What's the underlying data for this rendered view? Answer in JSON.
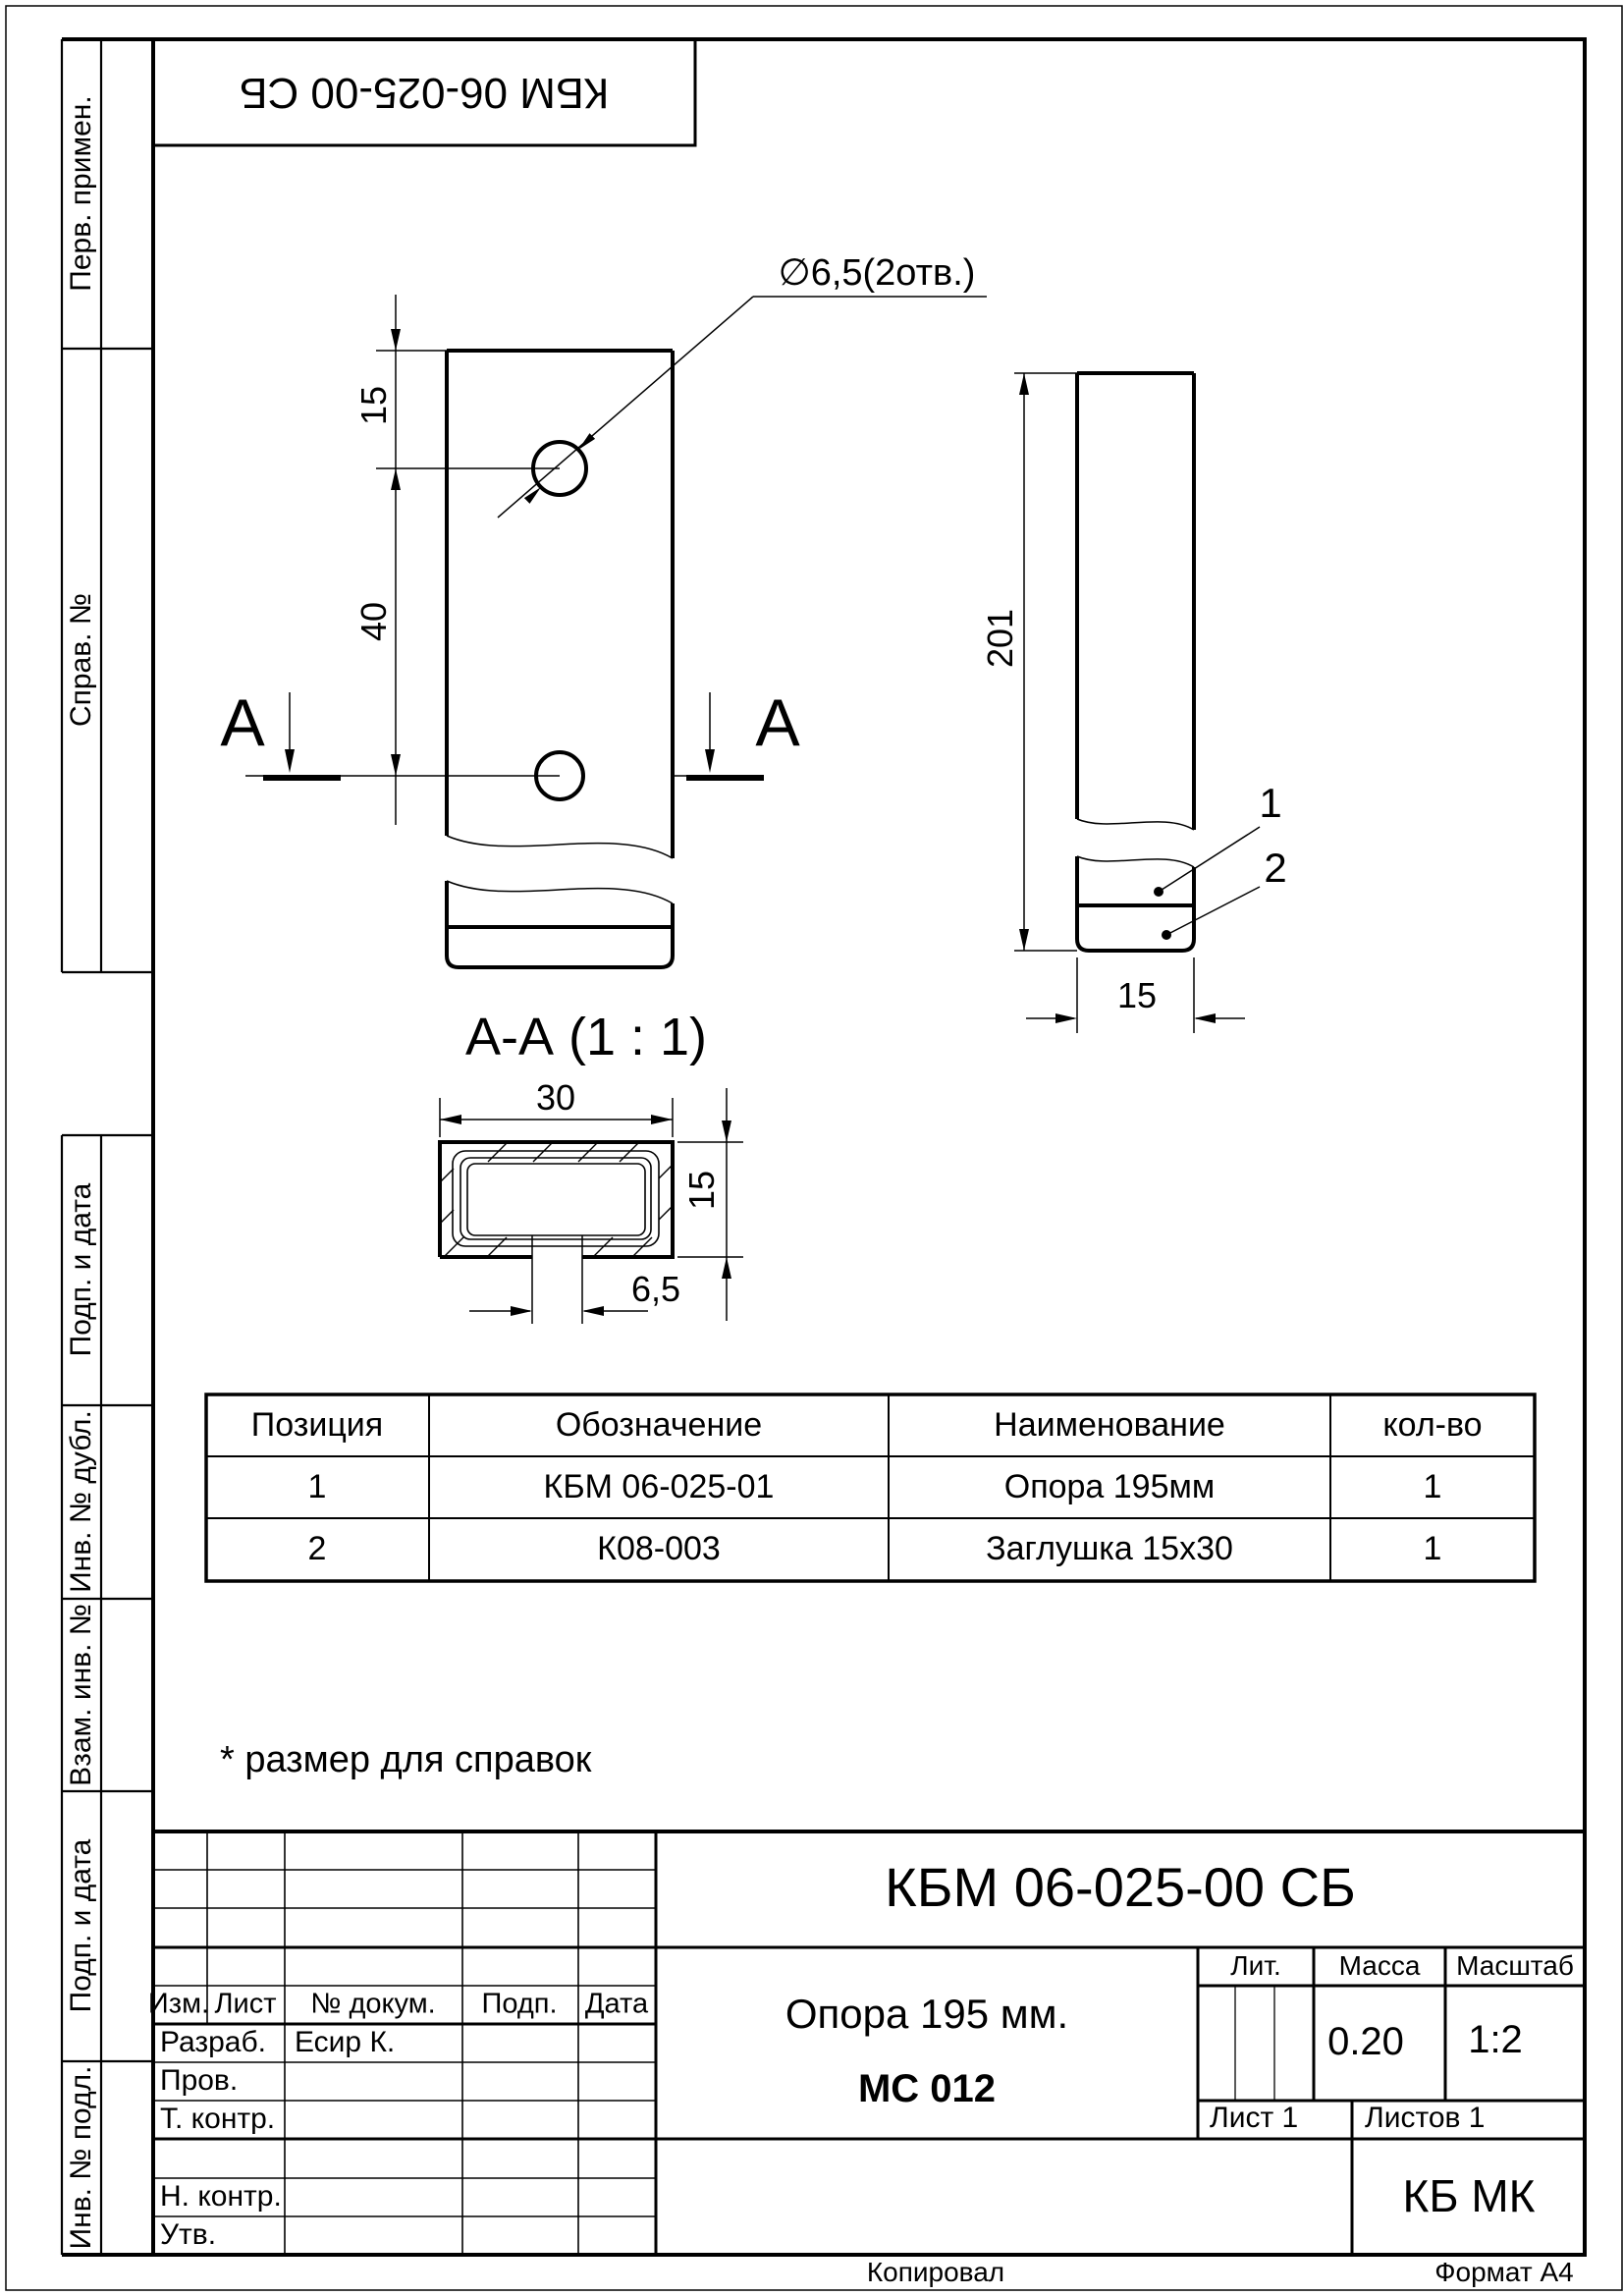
{
  "document": {
    "number": "КБМ 06-025-00 СБ",
    "name_line1": "Опора 195 мм.",
    "name_line2": "МС 012",
    "note": "* размер для справок",
    "footer_left": "Копировал",
    "footer_right": "Формат А4"
  },
  "margin_labels": {
    "perv_primen": "Перв. примен.",
    "sprav_no": "Справ. №",
    "podp_i_data_1": "Подп. и дата",
    "inv_no_dubl": "Инв. № дубл.",
    "vzam_inv_no": "Взам. инв. №",
    "podp_i_data_2": "Подп. и дата",
    "inv_no_podl": "Инв. № подл."
  },
  "drawing": {
    "front_view": {
      "dim_top": "15",
      "dim_between_holes": "40",
      "hole_callout": "∅6,5(2отв.)",
      "section_letter_left": "А",
      "section_letter_right": "А"
    },
    "side_view": {
      "dim_length": "201",
      "dim_width": "15",
      "position_1": "1",
      "position_2": "2"
    },
    "section_view": {
      "title": "А-А  (1 : 1)",
      "dim_width": "30",
      "dim_height": "15",
      "dim_hole": "6,5"
    }
  },
  "parts_table": {
    "headers": [
      "Позиция",
      "Обозначение",
      "Наименование",
      "кол-во"
    ],
    "rows": [
      [
        "1",
        "КБМ 06-025-01",
        "Опора 195мм",
        "1"
      ],
      [
        "2",
        "К08-003",
        "Заглушка 15х30",
        "1"
      ]
    ]
  },
  "title_block": {
    "designation": "КБМ 06-025-00 СБ",
    "change_headers": [
      "Изм.",
      "Лист",
      "№ докум.",
      "Подп.",
      "Дата"
    ],
    "row_labels": {
      "razrab": "Разраб.",
      "prov": "Пров.",
      "t_kontr": "Т. контр.",
      "n_kontr": "Н. контр.",
      "utv": "Утв."
    },
    "developer": "Есир К.",
    "lit_label": "Лит.",
    "mass_label": "Масса",
    "mass_value": "0.20",
    "scale_label": "Масштаб",
    "scale_value": "1:2",
    "sheet": "Лист 1",
    "sheets": "Листов 1",
    "company": "КБ МК"
  }
}
